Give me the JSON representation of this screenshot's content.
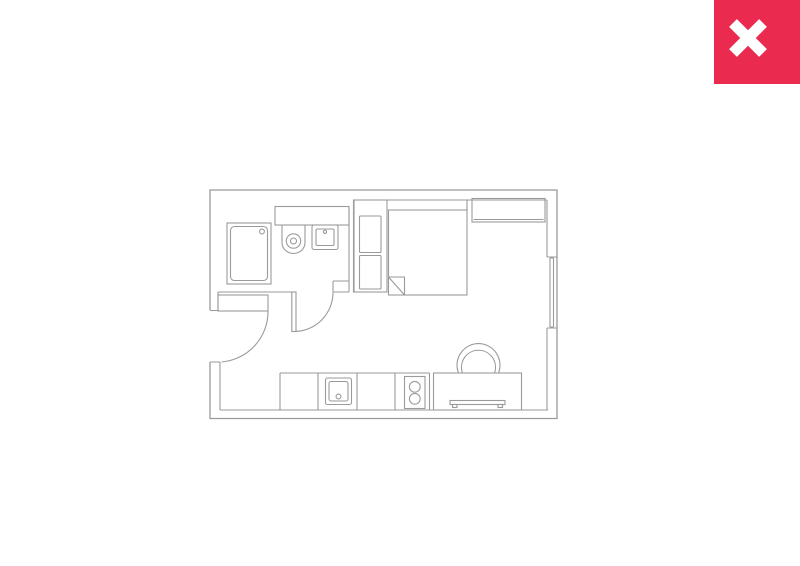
{
  "page": {
    "background": "#ffffff",
    "description": "Studio apartment floor plan image in a photo viewer with a close control"
  },
  "close_button": {
    "icon": "x-icon",
    "label": "close",
    "background": "#ea2a4e",
    "x_color": "#ffffff"
  },
  "floorplan": {
    "line_color": "#9a9a9a",
    "fill_color": "#ffffff",
    "rooms": [
      "bathroom",
      "sleeping-area",
      "kitchen-living-area",
      "entry"
    ],
    "fixtures": [
      "bathtub",
      "toilet",
      "wash-basin",
      "bathroom-counter",
      "bathroom-door",
      "entry-door",
      "wardrobe",
      "double-bed",
      "duvet-fold",
      "overbed-shelf",
      "window",
      "kitchen-counter",
      "kitchen-sink",
      "stove",
      "desk",
      "desk-chair"
    ]
  }
}
